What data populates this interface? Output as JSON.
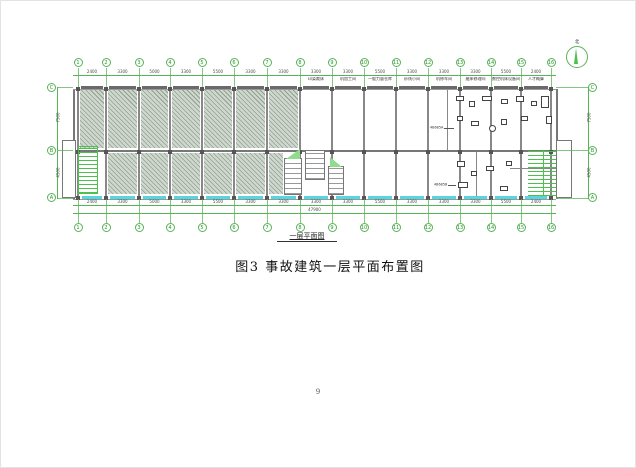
{
  "page": {
    "number": "9"
  },
  "figure": {
    "plan_label": "一层平面图",
    "caption": "图3 事故建筑一层平面布置图"
  },
  "plan": {
    "north_label": "北",
    "grid_columns": [
      "1",
      "2",
      "3",
      "4",
      "5",
      "6",
      "7",
      "8",
      "9",
      "10",
      "11",
      "12",
      "13",
      "14",
      "15",
      "16"
    ],
    "grid_rows": [
      "C",
      "B",
      "A"
    ],
    "dims_top": [
      "2400",
      "3300",
      "5000",
      "3300",
      "5500",
      "3300",
      "3300",
      "3300",
      "3300",
      "5500",
      "3300",
      "3300",
      "3300",
      "5500",
      "2400"
    ],
    "dims_bottom": [
      "2400",
      "3300",
      "5000",
      "3300",
      "5500",
      "3300",
      "3300",
      "3300",
      "3300",
      "5500",
      "3300",
      "3300",
      "3300",
      "5500",
      "2400"
    ],
    "total_dim": "47900",
    "side_dims": {
      "upper": "7500",
      "lower": "4500"
    },
    "room_labels": [
      "印染裁床",
      "机加工间",
      "一般力量仓库",
      "纱线小间",
      "机修车间",
      "磨床修理间",
      "数控机床设备间",
      "人才概算"
    ],
    "annotations": [
      "4B685A",
      "4B685B"
    ],
    "colors": {
      "grid_green": "#56b456",
      "stair_green": "#4ec04e",
      "window_cyan": "#55d6e0",
      "hatch_fill": "#cfd8cf",
      "wall_gray": "#6a6a6a"
    }
  }
}
